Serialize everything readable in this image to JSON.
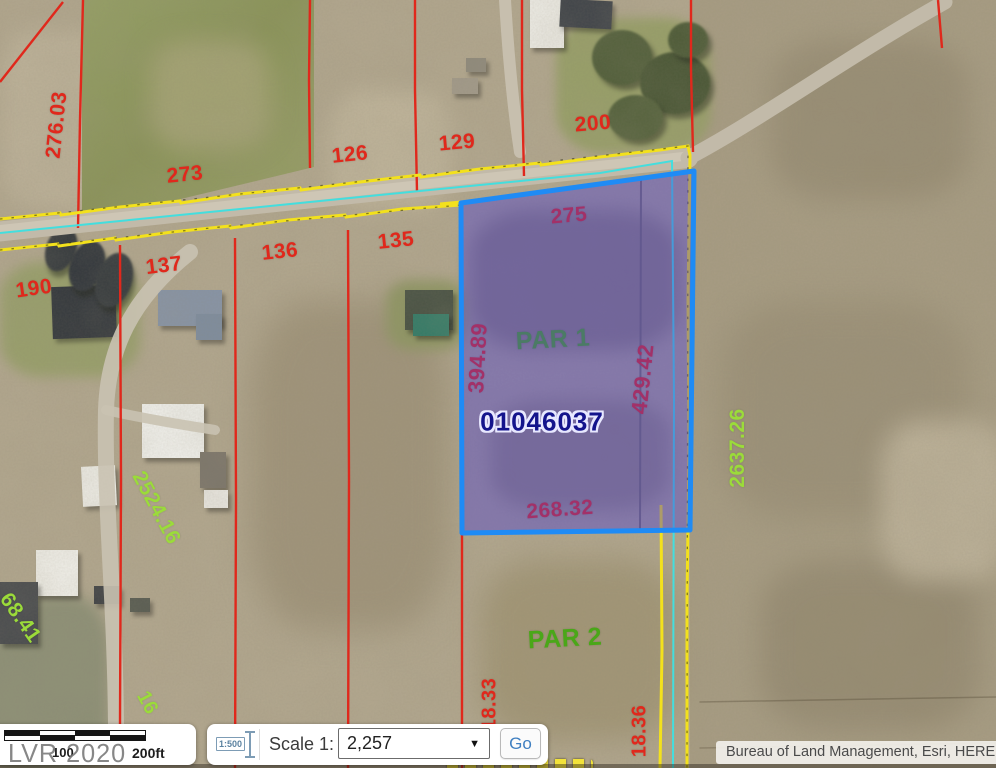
{
  "map": {
    "parcel_highlight": {
      "apn": "01046037",
      "fill": "rgba(76,62,209,0.42)",
      "stroke": "#1f8bf5"
    },
    "line_colors": {
      "red": "#e0281c",
      "yellow": "#f3e11c",
      "cyan": "#43dede"
    },
    "labels": [
      {
        "text": "276.03",
        "color": "#e0281c"
      },
      {
        "text": "273",
        "color": "#e0281c"
      },
      {
        "text": "126",
        "color": "#e0281c"
      },
      {
        "text": "129",
        "color": "#e0281c"
      },
      {
        "text": "200",
        "color": "#e0281c"
      },
      {
        "text": "190",
        "color": "#e0281c"
      },
      {
        "text": "137",
        "color": "#e0281c"
      },
      {
        "text": "136",
        "color": "#e0281c"
      },
      {
        "text": "135",
        "color": "#e0281c"
      },
      {
        "text": "275",
        "color": "#e0281c"
      },
      {
        "text": "394.89",
        "color": "#e0281c"
      },
      {
        "text": "429.42",
        "color": "#e0281c"
      },
      {
        "text": "268.32",
        "color": "#e0281c"
      },
      {
        "text": "18.33",
        "color": "#e0281c"
      },
      {
        "text": "18.36",
        "color": "#e0281c"
      },
      {
        "text": "PAR 1",
        "color": "#4aa718"
      },
      {
        "text": "PAR 2",
        "color": "#4aa718"
      },
      {
        "text": "2637.26",
        "color": "#9bdb3a"
      },
      {
        "text": "2524.16",
        "color": "#9bdb3a"
      },
      {
        "text": "68.41",
        "color": "#9bdb3a"
      },
      {
        "text": "16",
        "color": "#9bdb3a"
      },
      {
        "text": "01046037",
        "color": "#14148c"
      }
    ]
  },
  "scalebar": {
    "mid_label": "100",
    "end_label": "200ft"
  },
  "scale_control": {
    "icon_text": "1:500",
    "label": "Scale 1:",
    "value": "2,257",
    "button": "Go"
  },
  "icons": {
    "dropdown_arrow": "▼"
  },
  "watermark": "LVR 2020",
  "attribution": "Bureau of Land Management, Esri, HERE"
}
